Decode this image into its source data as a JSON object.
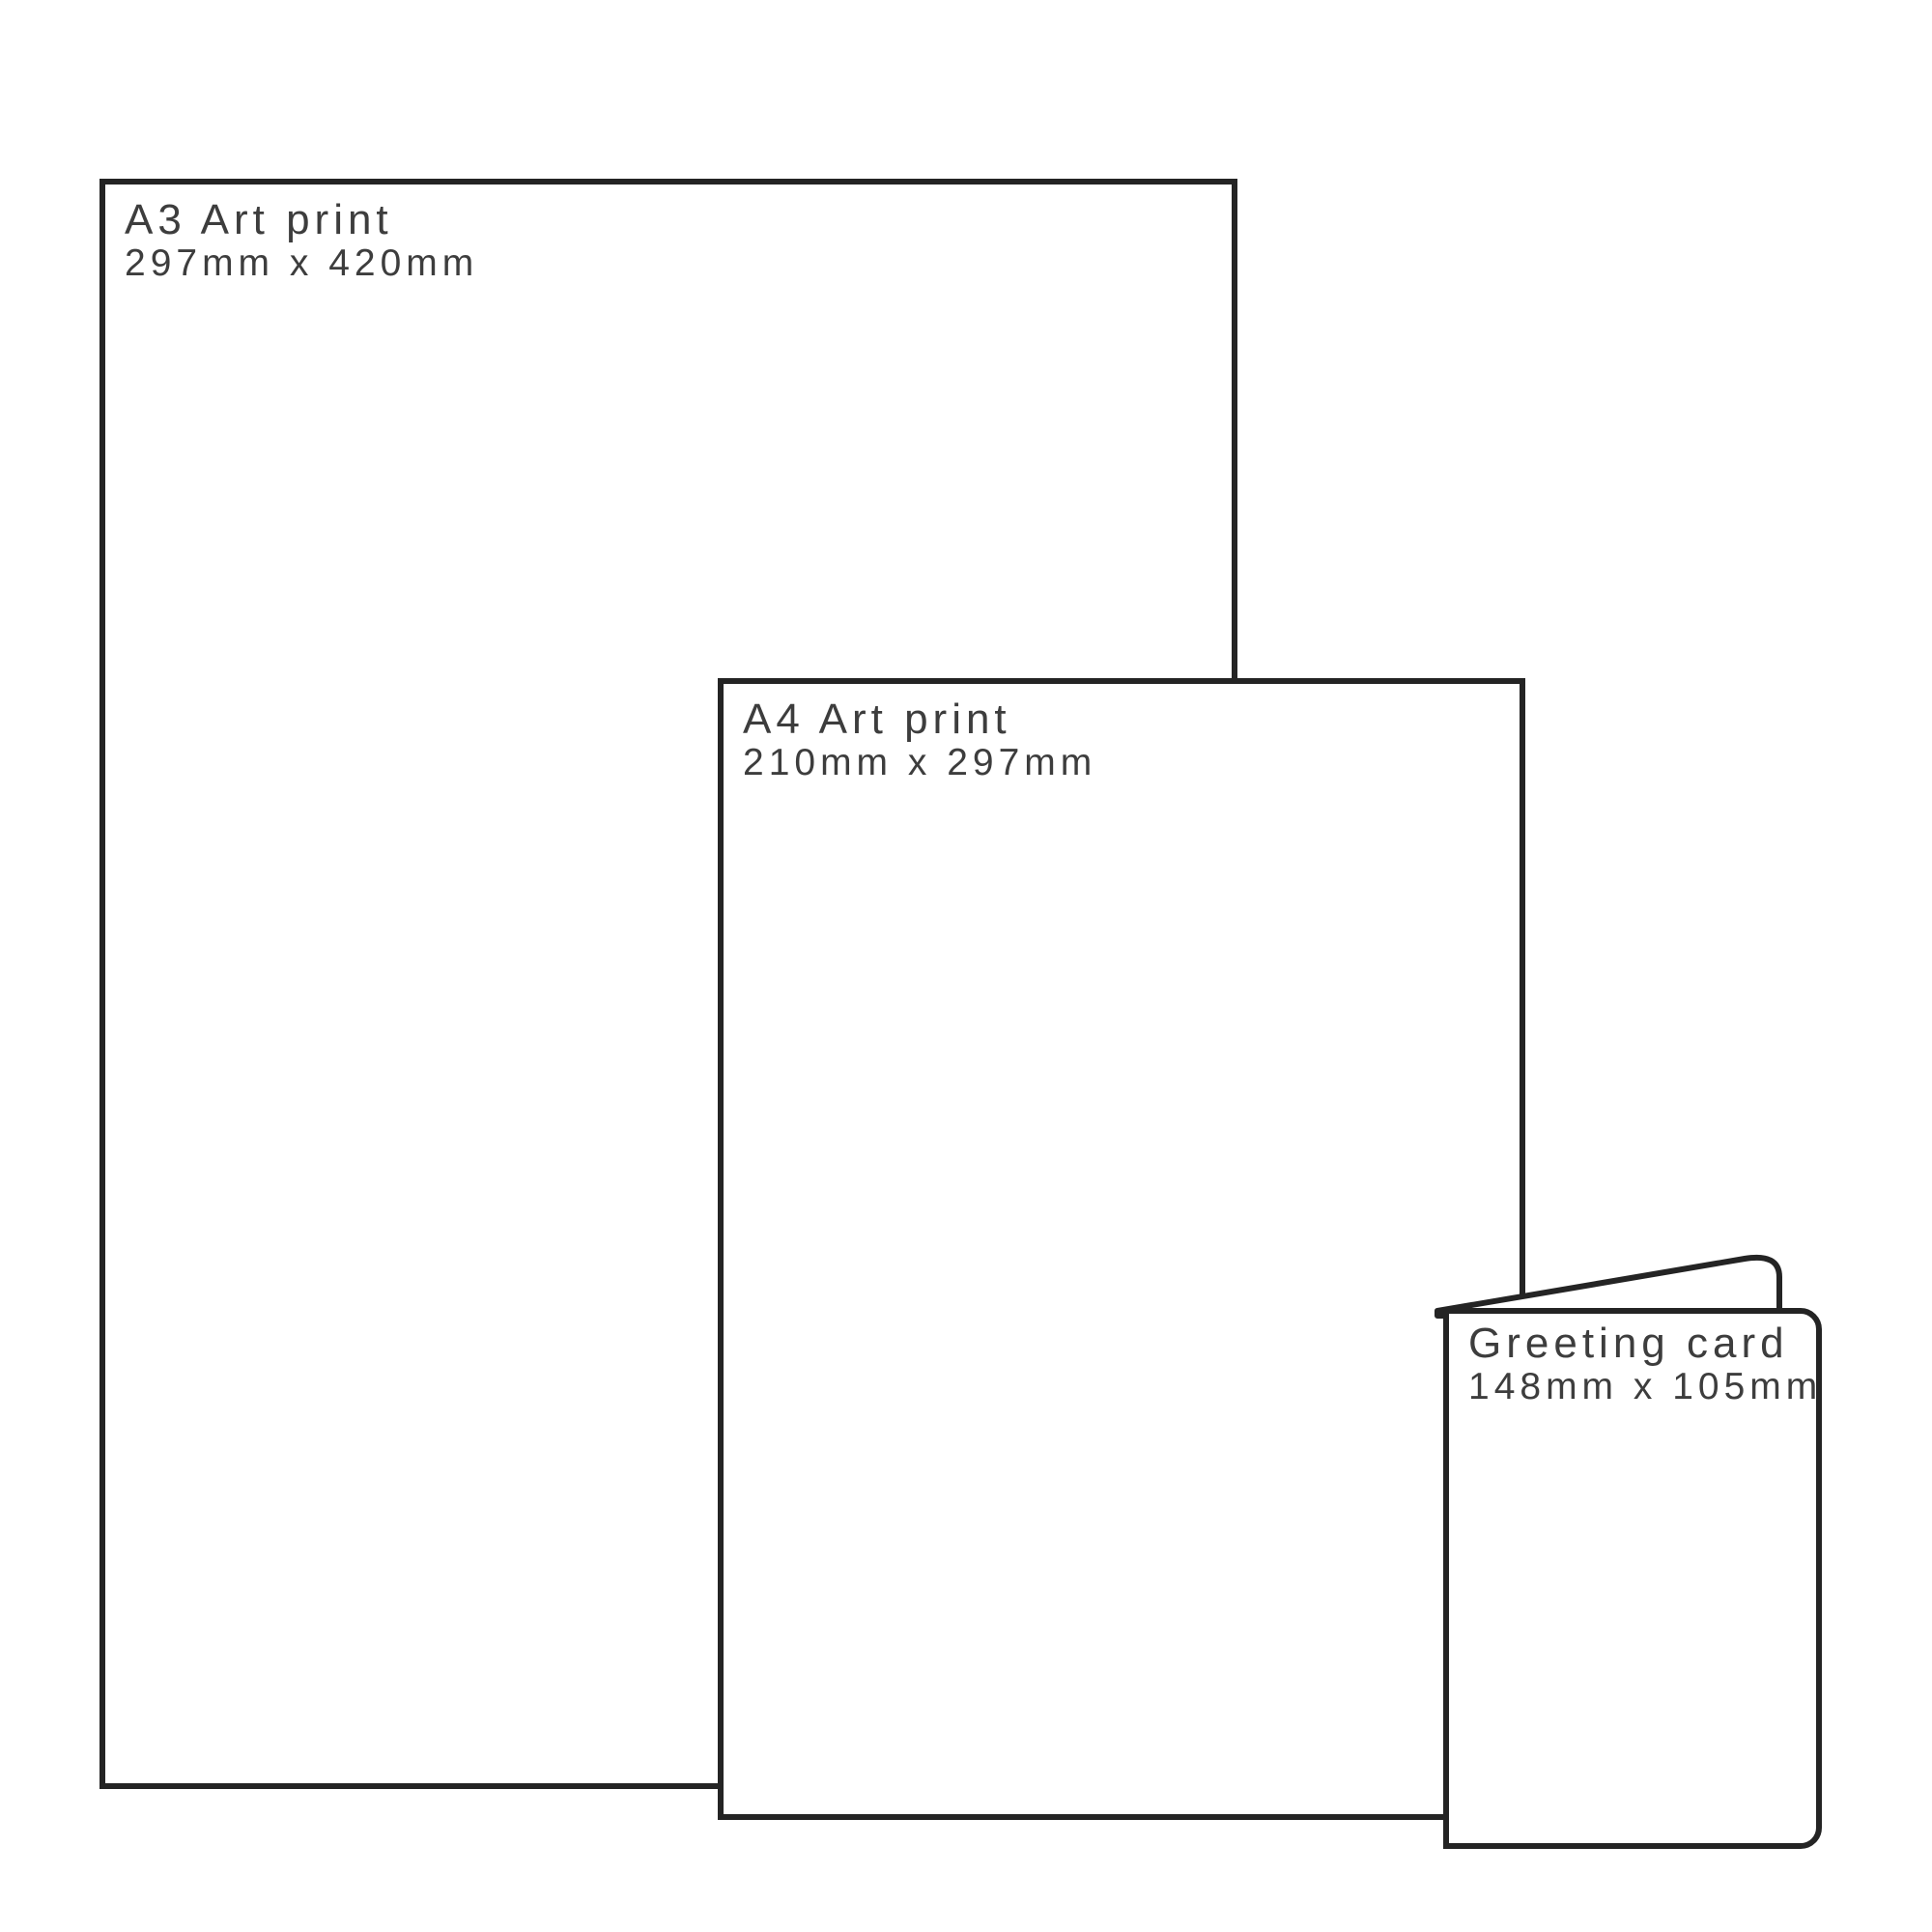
{
  "items": [
    {
      "id": "a3-art-print",
      "title": "A3 Art print",
      "dims": "297mm x 420mm"
    },
    {
      "id": "a4-art-print",
      "title": "A4 Art print",
      "dims": "210mm x 297mm"
    },
    {
      "id": "greeting-card",
      "title": "Greeting card",
      "dims": "148mm x 105mm"
    }
  ],
  "colors": {
    "outline": "#242424",
    "label_text": "#3d3d3d",
    "background": "#ffffff"
  }
}
